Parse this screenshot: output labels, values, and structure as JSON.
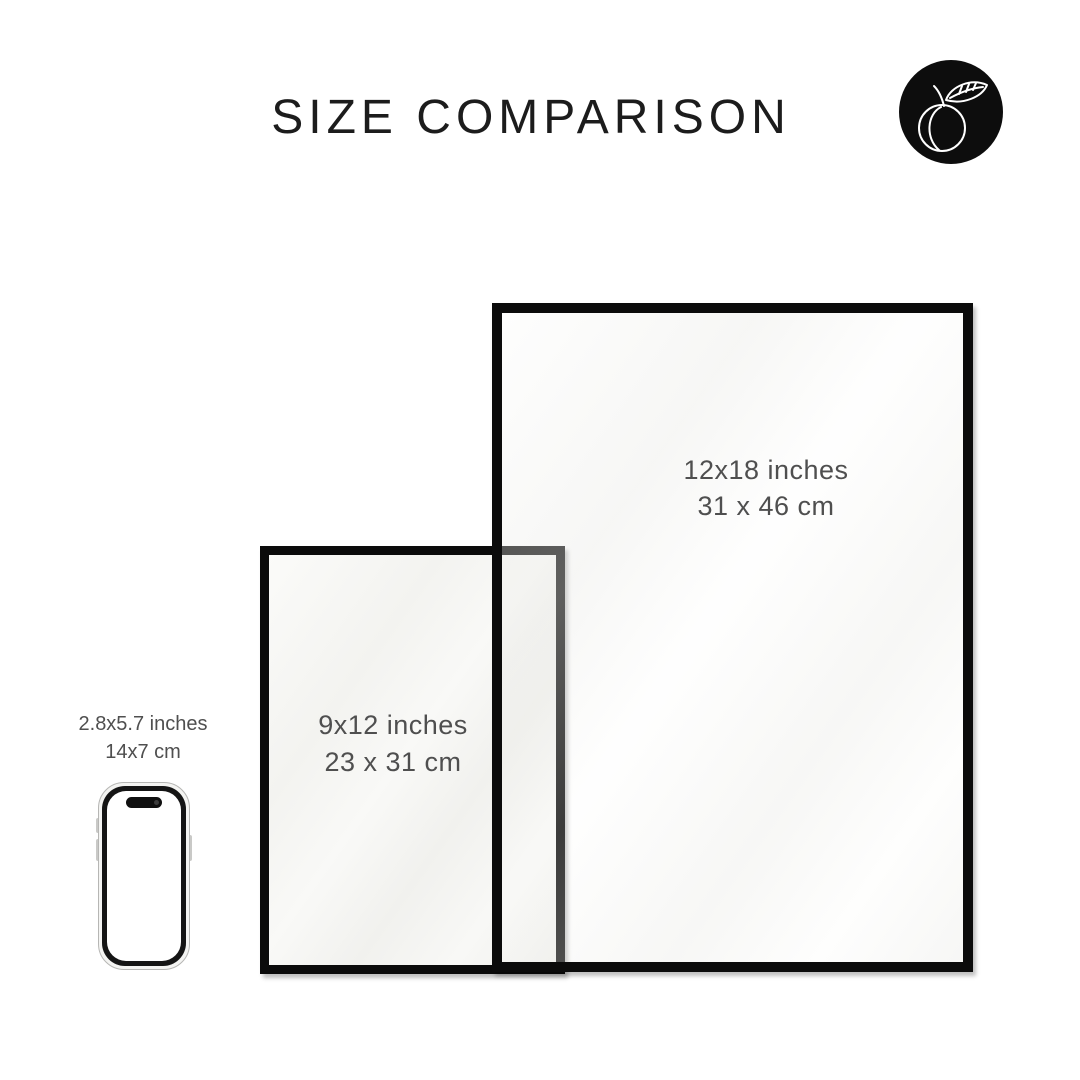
{
  "header": {
    "title": "SIZE COMPARISON"
  },
  "logo": {
    "icon": "peach-outline"
  },
  "frames": {
    "large": {
      "size_inches": "12x18 inches",
      "size_cm": "31 x 46 cm"
    },
    "small": {
      "size_inches": "9x12 inches",
      "size_cm": "23 x 31 cm"
    }
  },
  "phone": {
    "size_inches": "2.8x5.7 inches",
    "size_cm": "14x7 cm"
  },
  "colors": {
    "background": "#ffffff",
    "title_text": "#1c1c1c",
    "label_text": "#4f4f4f",
    "frame_border": "#0b0b0b",
    "logo_background": "#0d0d0d",
    "logo_stroke": "#ffffff"
  }
}
